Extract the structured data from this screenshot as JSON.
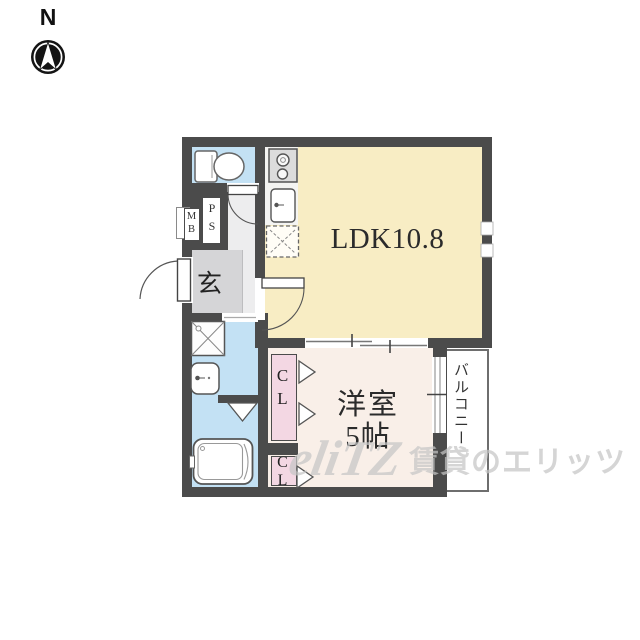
{
  "compass": {
    "label": "N"
  },
  "rooms": {
    "ldk": {
      "label": "LDK10.8"
    },
    "bedroom": {
      "name_line": "洋室",
      "size_line": "5帖"
    },
    "balcony": {
      "label": "バルコニー"
    },
    "entrance": {
      "label": "玄"
    },
    "closet_upper": {
      "label": "CL"
    },
    "closet_lower": {
      "label": "CL"
    },
    "pipe_shaft": {
      "label": "PS"
    },
    "meter_box": {
      "label": "MB"
    }
  },
  "fixtures": {
    "toilet": "toilet-icon",
    "stove": "two-burner-stove-icon",
    "kitchen_sink": "kitchen-sink-icon",
    "refrigerator_space": "refrigerator-space-icon",
    "washing_machine_space": "washing-machine-pan-icon",
    "washbasin": "washbasin-icon",
    "bathtub": "bathtub-icon"
  },
  "watermark": {
    "logo": "eliTZ",
    "text": "賃貸のエリッツ"
  },
  "colors": {
    "wall": "#4b4b4b",
    "ldk_floor": "#f8edc4",
    "bedroom_floor": "#f9efe8",
    "closet_floor": "#f3d7e3",
    "wet_area_floor": "#c3e1f4",
    "entrance_floor": "#d5d5d7",
    "hall_floor": "#ededee",
    "balcony_floor": "#ffffff",
    "watermark_gray": "#c6c6c6"
  }
}
